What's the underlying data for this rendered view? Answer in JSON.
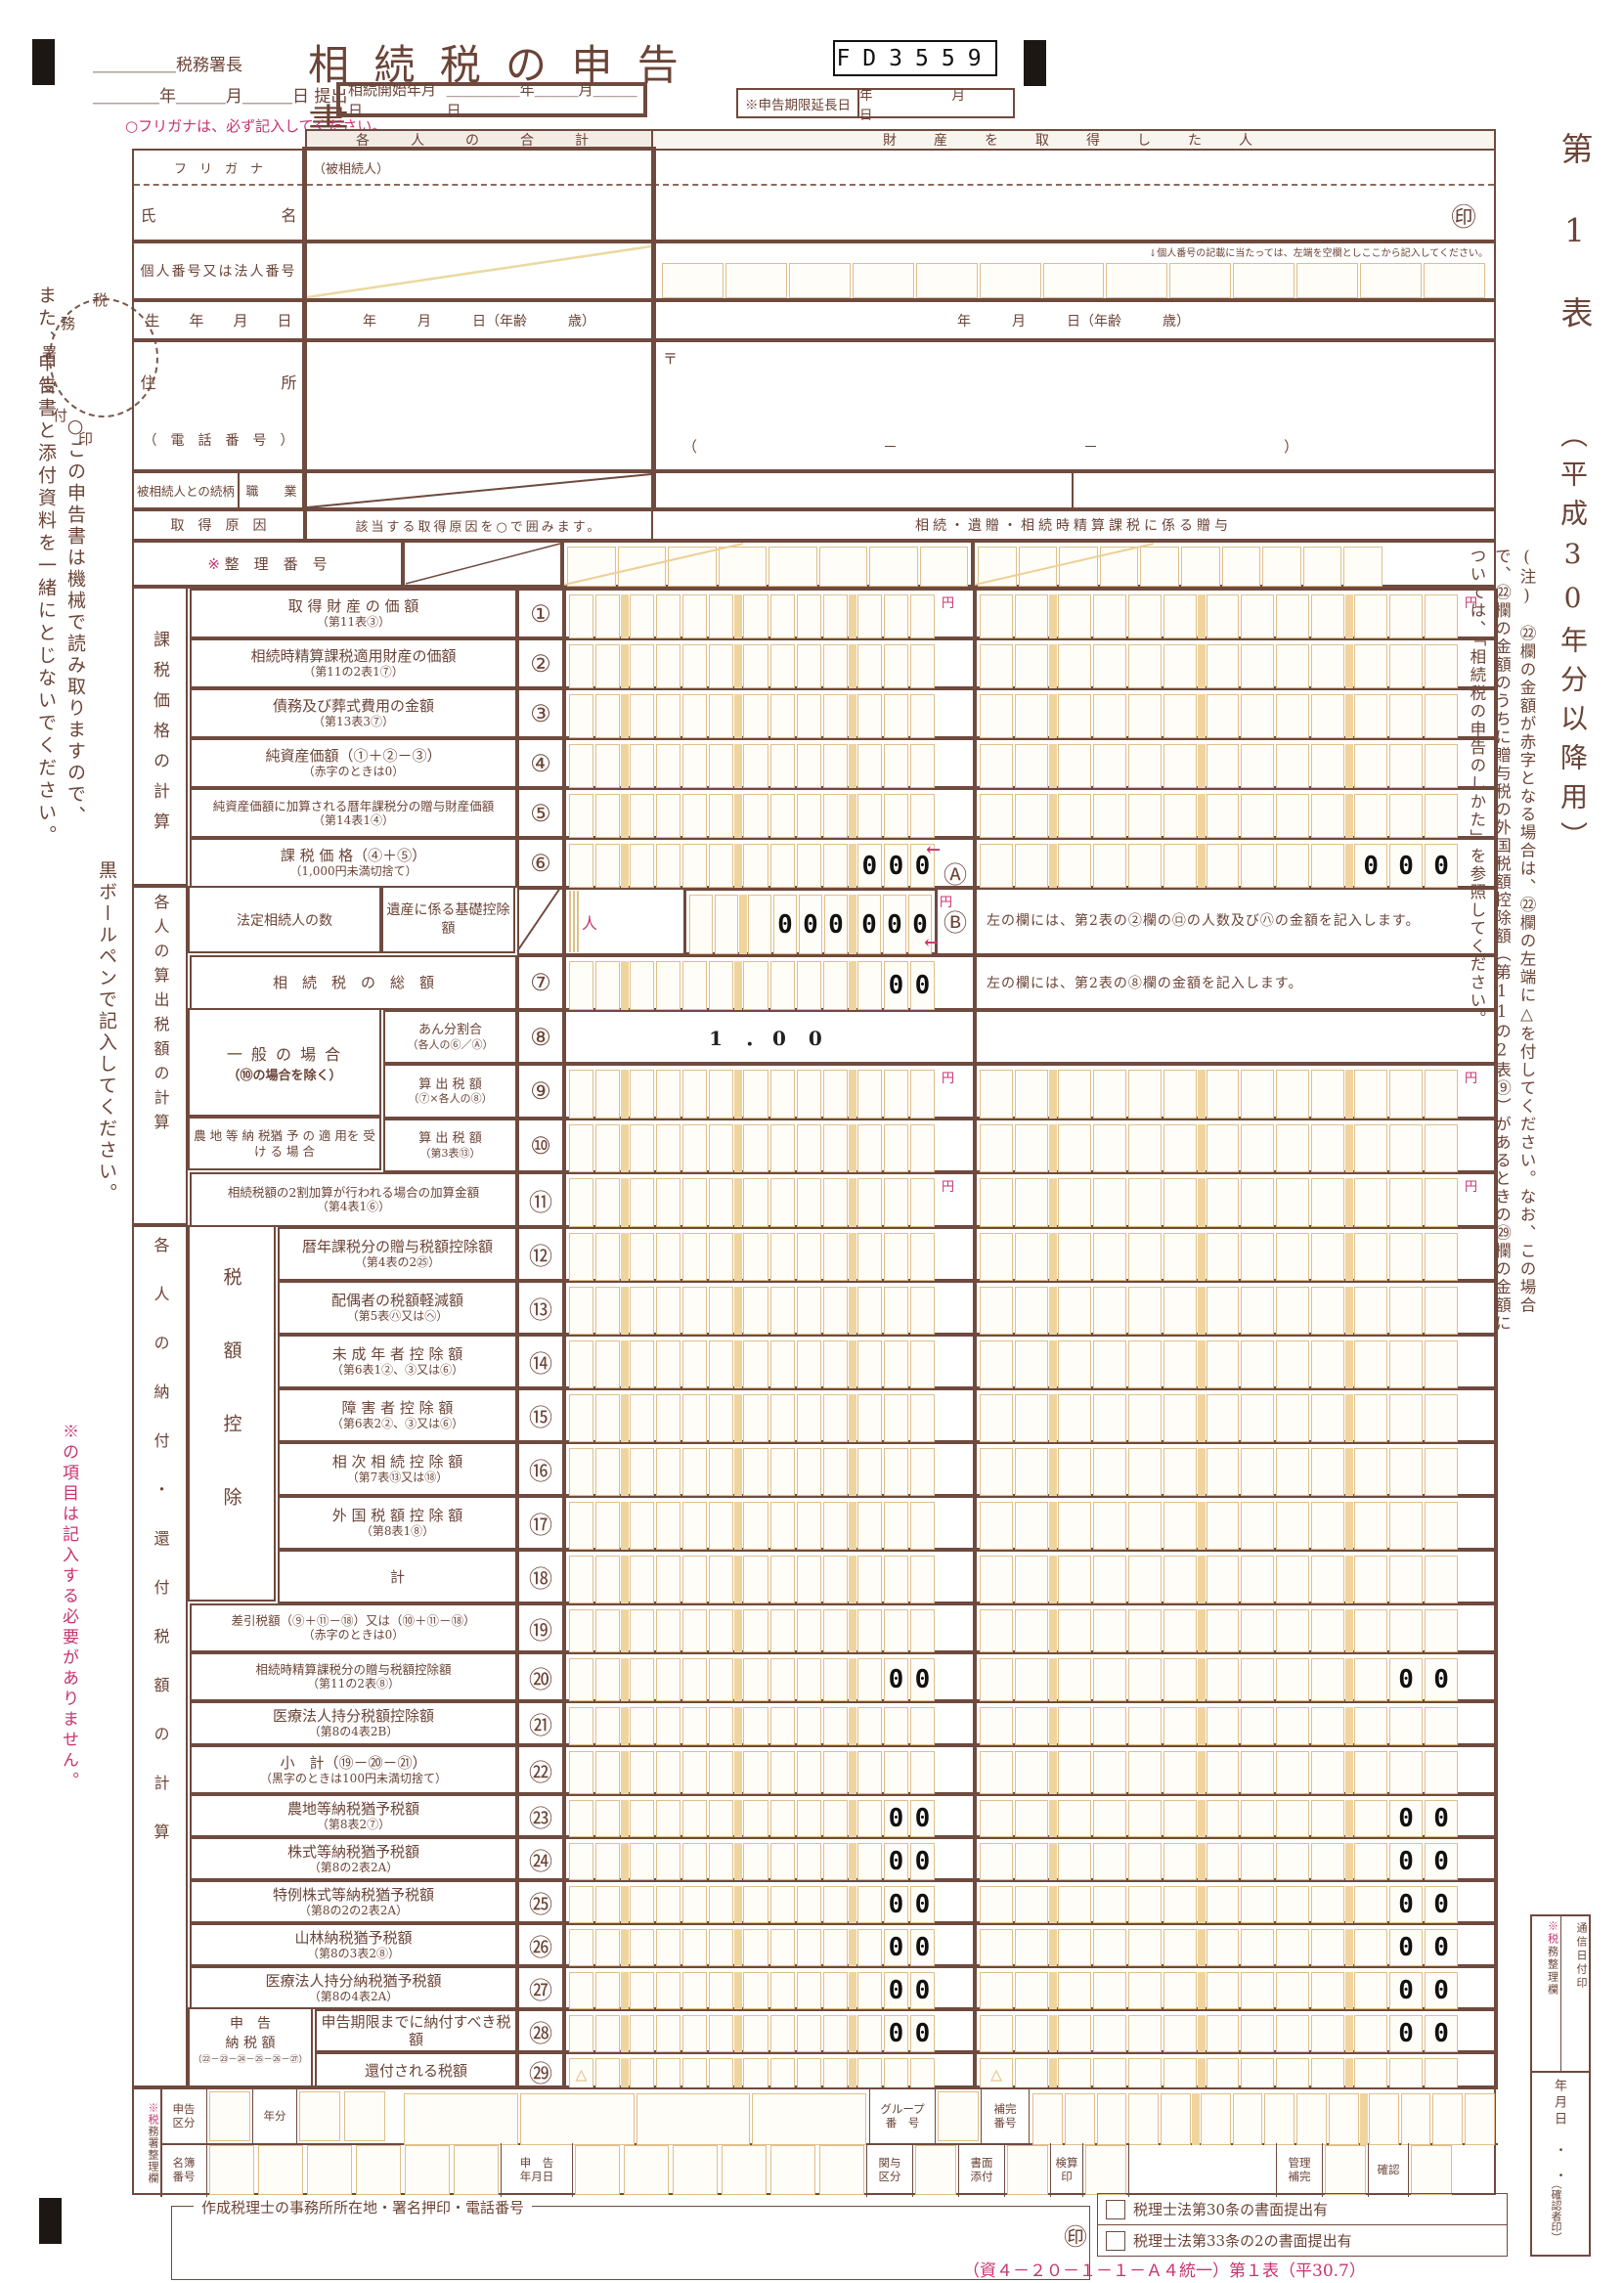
{
  "header": {
    "tax_office": "＿＿＿＿＿税務署長",
    "submit_date": "＿＿＿＿年＿＿＿月＿＿＿日 提出",
    "title": "相 続 税 の 申 告 書",
    "code": "FD3559",
    "start_label": "相続開始年月日",
    "start_date": "＿＿＿＿＿年＿＿＿月＿＿＿日",
    "ext_label": "※申告期限延長日",
    "ext_date": "年　　月　　日"
  },
  "notes": {
    "furigana": "○フリガナは、必ず記入してください。",
    "machine1": "○この申告書は機械で読み取りますので、",
    "machine2": "黒ボールペンで記入してください。",
    "attach": "また、申告書と添付資料を一緒にとじないでください。",
    "star_items": "※の項目は記入する必要がありません。",
    "mynumber": "↓個人番号の記載に当たっては、左端を空欄としここから記入してください。"
  },
  "stamp": "税務署受付印",
  "upper": {
    "sum_header": "各　人　の　合　計",
    "person_header": "財　産　を　取　得　し　た　人",
    "furigana": "フ　リ　ガ　ナ",
    "name": "氏　　　　　　　　名",
    "decedent": "（被相続人）",
    "number": "個人番号又は法人番号",
    "birth": "生　　年　　月　　日",
    "birth_value": "年　　　月　　　日（年齢　　　歳）",
    "address": "住　　　　　　　　所",
    "phone": "（　電　話　番　号　）",
    "postal": "〒",
    "phone_value": "（　　　　－　　　　－　　　　）",
    "relation": "被相続人との続柄",
    "occupation": "職　　業",
    "cause": "取　得　原　因",
    "cause_sum": "該当する取得原因を○で囲みます。",
    "cause_person": "相続・遺贈・相続時精算課税に係る贈与",
    "star": "※",
    "seirino": "整　理　番　号",
    "seal": "㊞"
  },
  "sidebar": {
    "title": "第1表",
    "subtitle": "（平成30年分以降用）",
    "note": "(注)　㉒欄の金額が赤字となる場合は、㉒欄の左端に△を付してください。なお、この場合で、㉒欄の金額のうちに贈与税の外国税額控除額（第11の2表⑨）があるときの㉙欄の金額については、「相続税の申告のしかた」を参照してください。",
    "strip": [
      "※税務整理欄",
      "通信日付印",
      "年月日",
      "・　・",
      "（確認者印）"
    ]
  },
  "money": {
    "groups": {
      "g1": "課税価格の計算",
      "g2": "各人の算出税額の計算",
      "g3": "各人の納付・還付税額の計算",
      "zeigaku": "税額控除",
      "shinkoku1": "申　告",
      "shinkoku2": "納 税 額",
      "shinkokuF": "（㉒－㉓－㉔－㉕－㉖－㉗）",
      "ippan1": "一 般 の 場 合",
      "ippan2": "（⑩の場合を除く）",
      "nochi": "農 地 等 納 税猶 予 の 適 用を 受 け る 場 合",
      "heirs1": "法定相続人の数",
      "heirs2": "遺産に係る基礎控除額"
    },
    "marks": {
      "a": "Ⓐ",
      "b": "Ⓑ",
      "yen": "円",
      "person_unit": "人",
      "arrow": "←",
      "triangle": "△"
    },
    "rows": [
      {
        "id": "1",
        "num": "①",
        "lbl": "取 得 財 産 の 価 額",
        "sub": "（第11表③）",
        "yen": true
      },
      {
        "id": "2",
        "num": "②",
        "lbl": "相続時精算課税適用財産の価額",
        "sub": "（第11の2表1⑦）"
      },
      {
        "id": "3",
        "num": "③",
        "lbl": "債務及び葬式費用の金額",
        "sub": "（第13表3⑦）"
      },
      {
        "id": "4",
        "num": "④",
        "lbl": "純資産価額（①＋②－③）",
        "sub": "（赤字のときは0）"
      },
      {
        "id": "5",
        "num": "⑤",
        "lbl": "純資産価額に加算される暦年課税分の贈与財産価額",
        "sub": "（第14表1④）",
        "small": true
      },
      {
        "id": "6",
        "num": "⑥",
        "lbl": "課 税 価 格（④＋⑤）",
        "sub": "（1,000円未満切捨て）",
        "preSum": "000",
        "prePerson": "000",
        "marker": "A"
      },
      {
        "id": "heirs",
        "type": "heirs",
        "preSum": "000000",
        "marker": "B",
        "note": "左の欄には、第2表の②欄の㋺の人数及び㋩の金額を記入します。"
      },
      {
        "id": "7",
        "num": "⑦",
        "lbl": "相　続　税　の　総　額",
        "preSum": "00",
        "note": "左の欄には、第2表の⑧欄の金額を記入します。"
      },
      {
        "id": "8",
        "num": "⑧",
        "type": "ratio",
        "lblR": "あん分割合",
        "subR": "（各人の⑥／Ⓐ）",
        "sumText": "1 ．0 0"
      },
      {
        "id": "9",
        "num": "⑨",
        "lblR": "算 出 税 額",
        "subR": "（⑦×各人の⑧）",
        "yen": true
      },
      {
        "id": "10",
        "num": "⑩",
        "lblL": true,
        "lblR": "算 出 税 額",
        "subR": "（第3表⑬）"
      },
      {
        "id": "11",
        "num": "⑪",
        "lbl": "相続税額の2割加算が行われる場合の加算金額",
        "sub": "（第4表1⑥）",
        "small": true,
        "yen": true
      },
      {
        "id": "12",
        "num": "⑫",
        "lbl": "暦年課税分の贈与税額控除額",
        "sub": "（第4表の2㉕）",
        "indent": 1
      },
      {
        "id": "13",
        "num": "⑬",
        "lbl": "配偶者の税額軽減額",
        "sub": "（第5表㋩又は㋬）",
        "indent": 1
      },
      {
        "id": "14",
        "num": "⑭",
        "lbl": "未 成 年 者 控 除 額",
        "sub": "（第6表1②、③又は⑥）",
        "indent": 1
      },
      {
        "id": "15",
        "num": "⑮",
        "lbl": "障 害 者 控 除 額",
        "sub": "（第6表2②、③又は⑥）",
        "indent": 1
      },
      {
        "id": "16",
        "num": "⑯",
        "lbl": "相 次 相 続 控 除 額",
        "sub": "（第7表⑬又は⑱）",
        "indent": 1
      },
      {
        "id": "17",
        "num": "⑰",
        "lbl": "外 国 税 額 控 除 額",
        "sub": "（第8表1⑧）",
        "indent": 1
      },
      {
        "id": "18",
        "num": "⑱",
        "lbl": "計",
        "indent": 1
      },
      {
        "id": "19",
        "num": "⑲",
        "lbl": "差引税額（⑨＋⑪－⑱）又は（⑩＋⑪－⑱）",
        "sub": "（赤字のときは0）",
        "small": true
      },
      {
        "id": "20",
        "num": "⑳",
        "lbl": "相続時精算課税分の贈与税額控除額",
        "sub": "（第11の2表⑧）",
        "small": true,
        "preSum": "00",
        "prePerson": "00"
      },
      {
        "id": "21",
        "num": "㉑",
        "lbl": "医療法人持分税額控除額",
        "sub": "（第8の4表2B）"
      },
      {
        "id": "22",
        "num": "㉒",
        "lbl": "小　計（⑲－⑳－㉑）",
        "sub": "（黒字のときは100円未満切捨て）"
      },
      {
        "id": "23",
        "num": "㉓",
        "lbl": "農地等納税猶予税額",
        "sub": "（第8表2⑦）",
        "preSum": "00",
        "prePerson": "00"
      },
      {
        "id": "24",
        "num": "㉔",
        "lbl": "株式等納税猶予税額",
        "sub": "（第8の2表2A）",
        "preSum": "00",
        "prePerson": "00"
      },
      {
        "id": "25",
        "num": "㉕",
        "lbl": "特例株式等納税猶予税額",
        "sub": "（第8の2の2表2A）",
        "preSum": "00",
        "prePerson": "00"
      },
      {
        "id": "26",
        "num": "㉖",
        "lbl": "山林納税猶予税額",
        "sub": "（第8の3表2⑧）",
        "preSum": "00",
        "prePerson": "00"
      },
      {
        "id": "27",
        "num": "㉗",
        "lbl": "医療法人持分納税猶予税額",
        "sub": "（第8の4表2A）",
        "preSum": "00",
        "prePerson": "00"
      },
      {
        "id": "28",
        "num": "㉘",
        "lbl": "申告期限までに納付すべき税額",
        "preSum": "00",
        "prePerson": "00",
        "indent": 2
      },
      {
        "id": "29",
        "num": "㉙",
        "lbl": "還付される税額",
        "tri": true,
        "indent": 2
      }
    ]
  },
  "admin": {
    "side": "※税務署整理欄",
    "row1": [
      [
        "l",
        "申告\n区分",
        46
      ],
      [
        "b"
      ],
      [
        "l",
        "年分",
        44
      ],
      [
        "b"
      ],
      [
        "b"
      ],
      [
        "g",
        14
      ],
      [
        "c",
        4
      ],
      [
        "l",
        "グループ\n番　号",
        66
      ],
      [
        "b"
      ],
      [
        "l",
        "補完\n番号",
        48
      ],
      [
        "c",
        14
      ]
    ],
    "row2": [
      [
        "l",
        "名簿\n番号",
        46
      ],
      [
        "bc",
        6
      ],
      [
        "l",
        "申　告\n年月日",
        72
      ],
      [
        "bc",
        6
      ],
      [
        "l",
        "関与\n区分",
        46
      ],
      [
        "b"
      ],
      [
        "l",
        "書面\n添付",
        46
      ],
      [
        "b"
      ],
      [
        "l",
        "検算\n印",
        32
      ],
      [
        "b"
      ],
      [
        "e",
        150
      ],
      [
        "l",
        "管理\n補完",
        46
      ],
      [
        "b"
      ],
      [
        "l",
        "確認",
        40
      ],
      [
        "b"
      ]
    ]
  },
  "accountant": {
    "label": "作成税理士の事務所所在地・署名押印・電話番号",
    "seal": "㊞",
    "checks": [
      "税理士法第30条の書面提出有",
      "税理士法第33条の2の書面提出有"
    ]
  },
  "footer": "（資４－２０－１－１－Ａ４統一）第１表（平30.7）"
}
